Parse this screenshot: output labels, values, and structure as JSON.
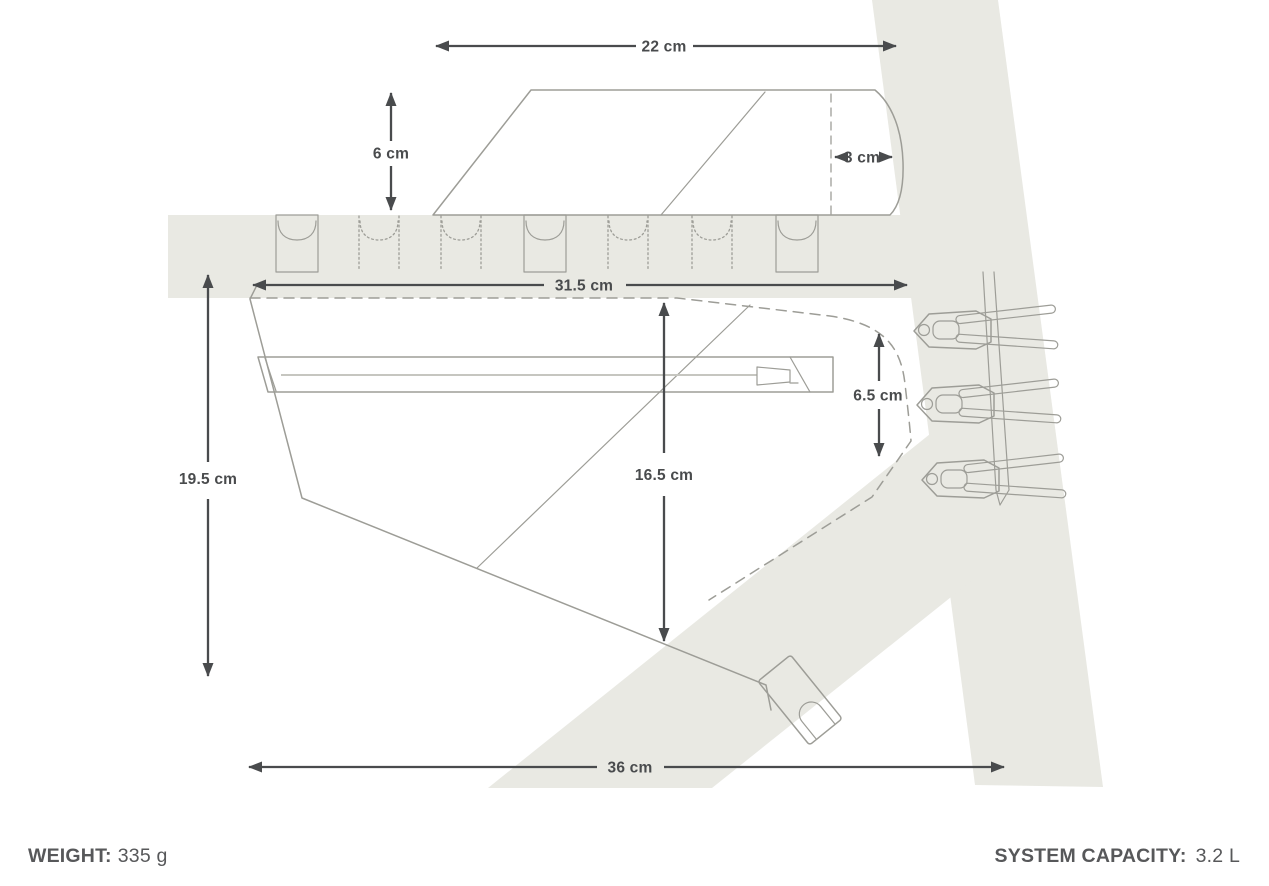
{
  "diagram": {
    "type": "bike-frame-bag-dimension-drawing",
    "dimensions": {
      "top_width": "22 cm",
      "flap_height": "6 cm",
      "flap_inset": "3 cm",
      "top_length": "31.5 cm",
      "rear_height": "6.5 cm",
      "center_height": "16.5 cm",
      "front_height": "19.5 cm",
      "bottom_length": "36 cm"
    },
    "specs": {
      "weight_label": "WEIGHT:",
      "weight_value": "335 g",
      "capacity_label": "SYSTEM CAPACITY:",
      "capacity_value": "3.2 L"
    },
    "colors": {
      "frame_fill": "#e9e9e3",
      "outline": "#9d9d97",
      "dimension": "#494b4d",
      "spec_text": "#57585a"
    }
  }
}
